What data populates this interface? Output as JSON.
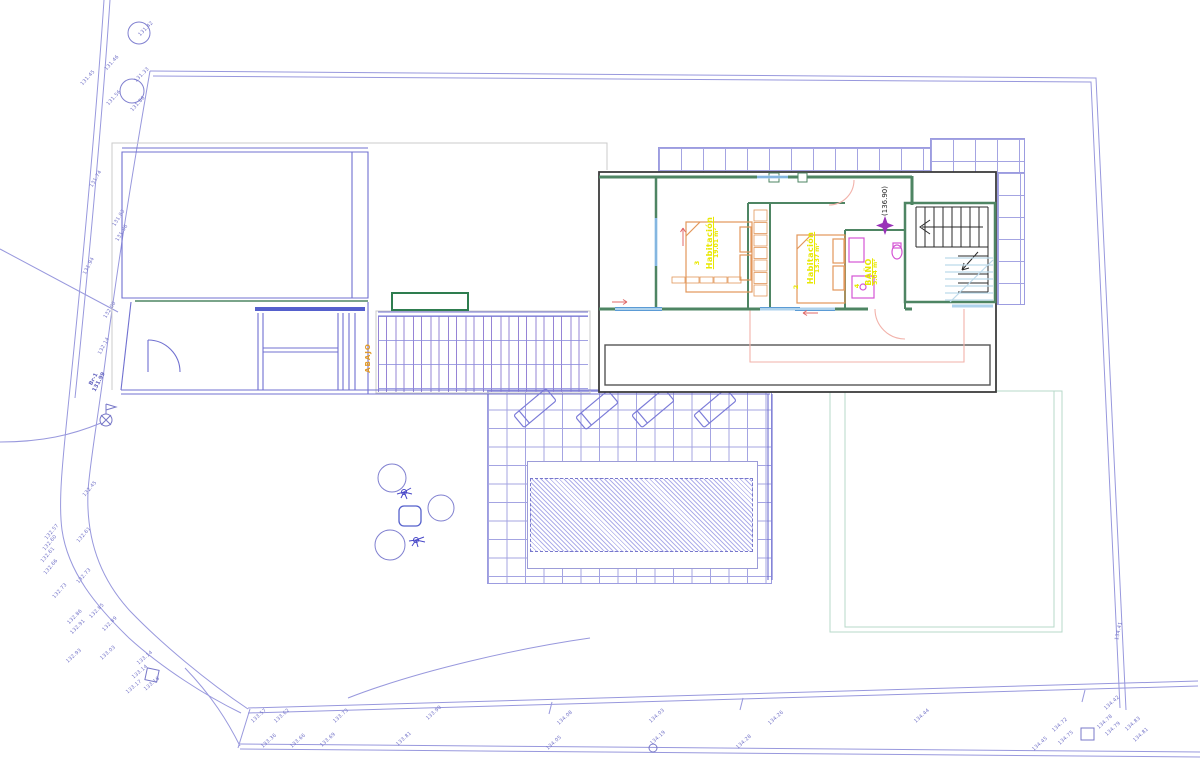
{
  "plan": {
    "level_label": "(136.90)",
    "abajo_label": "ABAJO",
    "rooms": [
      {
        "number": "3",
        "name": "Habitación",
        "area": "19.01 m²",
        "x": 713,
        "y": 243,
        "num_x": 697,
        "num_y": 263
      },
      {
        "number": "2",
        "name": "Habitación",
        "area": "13.37 m²",
        "x": 814,
        "y": 258,
        "num_x": 796,
        "num_y": 287
      },
      {
        "number": "4",
        "name": "BAÑO",
        "area": "5.04 m²",
        "x": 872,
        "y": 272,
        "num_x": 857,
        "num_y": 286
      }
    ]
  },
  "site": {
    "benchmark": {
      "name": "Br-1",
      "value": "131.99",
      "x": 97,
      "y": 381
    },
    "elevation_labels": [
      {
        "t": "131.42",
        "x": 146,
        "y": 29,
        "r": -45
      },
      {
        "t": "131.46",
        "x": 112,
        "y": 63,
        "r": -48
      },
      {
        "t": "131.45",
        "x": 88,
        "y": 78,
        "r": -48
      },
      {
        "t": "131.33",
        "x": 142,
        "y": 75,
        "r": -45
      },
      {
        "t": "131.56",
        "x": 114,
        "y": 98,
        "r": -48
      },
      {
        "t": "131.86",
        "x": 138,
        "y": 104,
        "r": -48
      },
      {
        "t": "131.74",
        "x": 96,
        "y": 179,
        "r": -60
      },
      {
        "t": "131.83",
        "x": 119,
        "y": 218,
        "r": -58
      },
      {
        "t": "131.96",
        "x": 122,
        "y": 233,
        "r": -58
      },
      {
        "t": "131.94",
        "x": 89,
        "y": 266,
        "r": -62
      },
      {
        "t": "132.00",
        "x": 110,
        "y": 310,
        "r": -58
      },
      {
        "t": "132.14",
        "x": 104,
        "y": 346,
        "r": -62
      },
      {
        "t": "132.45",
        "x": 90,
        "y": 489,
        "r": -50
      },
      {
        "t": "132.57",
        "x": 52,
        "y": 532,
        "r": -50
      },
      {
        "t": "132.60",
        "x": 50,
        "y": 543,
        "r": -50
      },
      {
        "t": "132.61",
        "x": 48,
        "y": 555,
        "r": -50
      },
      {
        "t": "132.61",
        "x": 84,
        "y": 535,
        "r": -50
      },
      {
        "t": "132.66",
        "x": 51,
        "y": 567,
        "r": -50
      },
      {
        "t": "132.73",
        "x": 84,
        "y": 576,
        "r": -48
      },
      {
        "t": "132.73",
        "x": 60,
        "y": 591,
        "r": -48
      },
      {
        "t": "132.85",
        "x": 97,
        "y": 611,
        "r": -45
      },
      {
        "t": "132.86",
        "x": 75,
        "y": 617,
        "r": -45
      },
      {
        "t": "132.91",
        "x": 78,
        "y": 627,
        "r": -45
      },
      {
        "t": "132.89",
        "x": 110,
        "y": 624,
        "r": -45
      },
      {
        "t": "132.93",
        "x": 74,
        "y": 656,
        "r": -42
      },
      {
        "t": "133.03",
        "x": 108,
        "y": 653,
        "r": -42
      },
      {
        "t": "133.14",
        "x": 145,
        "y": 658,
        "r": -40
      },
      {
        "t": "133.14",
        "x": 140,
        "y": 672,
        "r": -40
      },
      {
        "t": "133.17",
        "x": 134,
        "y": 687,
        "r": -40
      },
      {
        "t": "133.16",
        "x": 152,
        "y": 684,
        "r": -40
      },
      {
        "t": "133.57",
        "x": 259,
        "y": 716,
        "r": -42
      },
      {
        "t": "133.62",
        "x": 282,
        "y": 716,
        "r": -42
      },
      {
        "t": "133.73",
        "x": 341,
        "y": 716,
        "r": -42
      },
      {
        "t": "133.90",
        "x": 434,
        "y": 713,
        "r": -42
      },
      {
        "t": "133.36",
        "x": 269,
        "y": 741,
        "r": -42
      },
      {
        "t": "133.66",
        "x": 298,
        "y": 741,
        "r": -42
      },
      {
        "t": "133.69",
        "x": 328,
        "y": 740,
        "r": -42
      },
      {
        "t": "133.81",
        "x": 404,
        "y": 739,
        "r": -42
      },
      {
        "t": "134.08",
        "x": 565,
        "y": 718,
        "r": -42
      },
      {
        "t": "134.03",
        "x": 657,
        "y": 716,
        "r": -42
      },
      {
        "t": "134.05",
        "x": 554,
        "y": 743,
        "r": -42
      },
      {
        "t": "134.19",
        "x": 658,
        "y": 738,
        "r": -42
      },
      {
        "t": "134.28",
        "x": 744,
        "y": 742,
        "r": -42
      },
      {
        "t": "134.26",
        "x": 776,
        "y": 718,
        "r": -42
      },
      {
        "t": "134.44",
        "x": 922,
        "y": 716,
        "r": -42
      },
      {
        "t": "134.45",
        "x": 1040,
        "y": 744,
        "r": -42
      },
      {
        "t": "134.72",
        "x": 1060,
        "y": 725,
        "r": -42
      },
      {
        "t": "134.75",
        "x": 1066,
        "y": 738,
        "r": -42
      },
      {
        "t": "134.78",
        "x": 1105,
        "y": 722,
        "r": -42
      },
      {
        "t": "134.79",
        "x": 1113,
        "y": 729,
        "r": -42
      },
      {
        "t": "134.83",
        "x": 1133,
        "y": 724,
        "r": -42
      },
      {
        "t": "134.81",
        "x": 1141,
        "y": 735,
        "r": -42
      },
      {
        "t": "134.42",
        "x": 1112,
        "y": 703,
        "r": -42
      },
      {
        "t": "134.41",
        "x": 1119,
        "y": 631,
        "r": -78
      }
    ]
  },
  "colors": {
    "boundary": "#9898dd",
    "grid": "#a4a4e2",
    "walls_green": "#4e8563",
    "planter_green": "#2e7d4f",
    "furniture_orange": "#e2975a",
    "bath_magenta": "#d455d4",
    "label_yellow": "#e8e800",
    "label_blue": "#7474c8",
    "star_purple": "#9932b8",
    "abajo_orange": "#e09a28",
    "window_blue": "#aed2ec",
    "door_salmon": "#f2b2aa",
    "stair_black": "#2a2a2a",
    "inset_border": "#3c3c3c"
  }
}
